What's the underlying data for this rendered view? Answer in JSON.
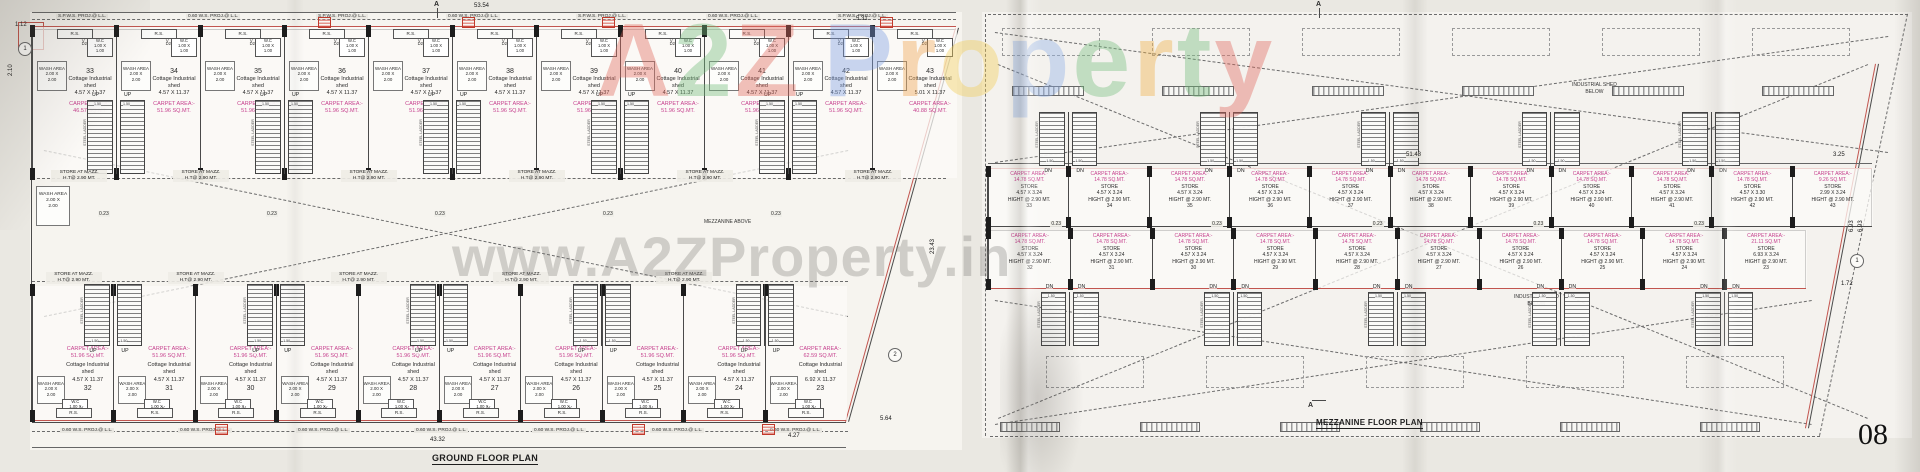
{
  "page": {
    "number": "08"
  },
  "watermark": {
    "brand_letters": [
      {
        "ch": "A",
        "color": "#e2695e"
      },
      {
        "ch": "2",
        "color": "#74bd7c"
      },
      {
        "ch": "Z",
        "color": "#e2695e"
      },
      {
        "ch": "P",
        "color": "#7d9fe3"
      },
      {
        "ch": "r",
        "color": "#f0a44f"
      },
      {
        "ch": "o",
        "color": "#f3ce58"
      },
      {
        "ch": "p",
        "color": "#8fb0e8"
      },
      {
        "ch": "e",
        "color": "#77c07f"
      },
      {
        "ch": "r",
        "color": "#f0b045"
      },
      {
        "ch": "t",
        "color": "#74bd7c"
      },
      {
        "ch": "y",
        "color": "#e2695e"
      }
    ],
    "url_text": "www.A2ZProperty.in"
  },
  "ground_floor": {
    "title": "GROUND FLOOR PLAN",
    "labels": {
      "rs": "R.S.",
      "vent": "V",
      "wc": "W.C",
      "wc_size": "1.00 X",
      "wc_size2": "1.00",
      "door": "D2",
      "wash1": "WASH AREA",
      "wash2": "2.00 X",
      "wash3": "2.00",
      "up": "UP",
      "unit_type1": "Cottage Industrial",
      "unit_type2": "shed",
      "carpet": "CARPET AREA:-",
      "store_mazz1": "STORE AT MAZZ.",
      "store_mazz2": "H.T@ 2.90 MT.",
      "mezz_above": "MEZZANINE ABOVE",
      "steel_ladder": "STEEL LADDER",
      "stair_width": "1.50"
    },
    "dims": {
      "total_top": "53.54",
      "top_right": "5.31",
      "left_offset": "1.12",
      "left_height": "2.10",
      "right_height": "23.43",
      "right_lower": "5.64",
      "bottom_offset": "4.27",
      "total_bottom": "43.32",
      "column_gap": "0.23"
    },
    "markers": {
      "left": "1",
      "right": "2",
      "section": "A"
    },
    "top_edge_labels": [
      "S.P.W.S. PROJ.@ L.L.",
      "0.60 W.S. PROJ.@ L.L.",
      "S.P.W.S. PROJ.@ L.L.",
      "0.60 W.S. PROJ.@ L.L.",
      "S.P.W.S. PROJ.@ L.L.",
      "0.60 W.S. PROJ.@ L.L.",
      "S.P.W.S. PROJ.@ L.L."
    ],
    "bottom_edge_labels": [
      "0.60 W.S. PROJ.@ L.L.",
      "0.60 W.S. PROJ.@ L.L.",
      "0.60 W.S. PROJ.@ L.L.",
      "0.60 W.S. PROJ.@ L.L.",
      "0.60 W.S. PROJ.@ L.L.",
      "0.60 W.S. PROJ.@ L.L.",
      "0.60 W.S. PROJ.@ L.L."
    ],
    "top_units": [
      {
        "no": "33",
        "size": "4.57 X 11.37",
        "area": "46.57 SQ.MT."
      },
      {
        "no": "34",
        "size": "4.57 X 11.37",
        "area": "51.96 SQ.MT."
      },
      {
        "no": "35",
        "size": "4.57 X 11.37",
        "area": "51.96 SQ.MT."
      },
      {
        "no": "36",
        "size": "4.57 X 11.37",
        "area": "51.96 SQ.MT."
      },
      {
        "no": "37",
        "size": "4.57 X 11.37",
        "area": "51.96 SQ.MT."
      },
      {
        "no": "38",
        "size": "4.57 X 11.37",
        "area": "51.96 SQ.MT."
      },
      {
        "no": "39",
        "size": "4.57 X 11.37",
        "area": "51.96 SQ.MT."
      },
      {
        "no": "40",
        "size": "4.57 X 11.37",
        "area": "51.96 SQ.MT."
      },
      {
        "no": "41",
        "size": "4.57 X 11.37",
        "area": "51.96 SQ.MT."
      },
      {
        "no": "42",
        "size": "4.57 X 11.37",
        "area": "51.96 SQ.MT."
      },
      {
        "no": "43",
        "size": "5.01 X 11.37",
        "area": "40.88 SQ.MT."
      }
    ],
    "bottom_units": [
      {
        "no": "32",
        "size": "4.57 X 11.37",
        "area": "51.96 SQ.MT."
      },
      {
        "no": "31",
        "size": "4.57 X 11.37",
        "area": "51.96 SQ.MT."
      },
      {
        "no": "30",
        "size": "4.57 X 11.37",
        "area": "51.96 SQ.MT."
      },
      {
        "no": "29",
        "size": "4.57 X 11.37",
        "area": "51.96 SQ.MT."
      },
      {
        "no": "28",
        "size": "4.57 X 11.37",
        "area": "51.96 SQ.MT."
      },
      {
        "no": "27",
        "size": "4.57 X 11.37",
        "area": "51.96 SQ.MT."
      },
      {
        "no": "26",
        "size": "4.57 X 11.37",
        "area": "51.96 SQ.MT."
      },
      {
        "no": "25",
        "size": "4.57 X 11.37",
        "area": "51.96 SQ.MT."
      },
      {
        "no": "24",
        "size": "4.57 X 11.37",
        "area": "51.96 SQ.MT."
      },
      {
        "no": "23",
        "size": "6.92 X 11.37",
        "area": "62.59 SQ.MT."
      }
    ]
  },
  "mezzanine": {
    "title": "MEZZANINE FLOOR PLAN",
    "labels": {
      "carpet": "CARPET AREA:-",
      "store": "STORE",
      "hight": "HIGHT @ 2.90 MT.",
      "dn": "DN",
      "shed_below1": "INDUSTRIAL SHED",
      "shed_below2": "BELOW",
      "steel_ladder": "STEEL LADDER"
    },
    "dims": {
      "total": "51.48",
      "right_top": "3.25",
      "right_h1": "6.93",
      "right_h2": "6.93",
      "right_lower": "1.72",
      "column_gap": "0.23"
    },
    "markers": {
      "right": "1",
      "section": "A"
    },
    "top_units": [
      {
        "no": "33",
        "area": "14.78 SQ.MT.",
        "size": "4.57 X 3.24"
      },
      {
        "no": "34",
        "area": "14.78 SQ.MT.",
        "size": "4.57 X 3.24"
      },
      {
        "no": "35",
        "area": "14.78 SQ.MT.",
        "size": "4.57 X 3.24"
      },
      {
        "no": "36",
        "area": "14.78 SQ.MT.",
        "size": "4.57 X 3.24"
      },
      {
        "no": "37",
        "area": "14.78 SQ.MT.",
        "size": "4.57 X 3.24"
      },
      {
        "no": "38",
        "area": "14.78 SQ.MT.",
        "size": "4.57 X 3.24"
      },
      {
        "no": "39",
        "area": "14.78 SQ.MT.",
        "size": "4.57 X 3.24"
      },
      {
        "no": "40",
        "area": "14.78 SQ.MT.",
        "size": "4.57 X 3.24"
      },
      {
        "no": "41",
        "area": "14.78 SQ.MT.",
        "size": "4.57 X 3.24"
      },
      {
        "no": "42",
        "area": "14.78 SQ.MT.",
        "size": "4.57 X 3.30"
      },
      {
        "no": "43",
        "area": "9.26 SQ.MT.",
        "size": "2.99 X 3.24"
      }
    ],
    "bottom_units": [
      {
        "no": "32",
        "area": "14.78 SQ.MT.",
        "size": "4.57 X 3.24"
      },
      {
        "no": "31",
        "area": "14.78 SQ.MT.",
        "size": "4.57 X 3.24"
      },
      {
        "no": "30",
        "area": "14.78 SQ.MT.",
        "size": "4.57 X 3.24"
      },
      {
        "no": "29",
        "area": "14.78 SQ.MT.",
        "size": "4.57 X 3.24"
      },
      {
        "no": "28",
        "area": "14.78 SQ.MT.",
        "size": "4.57 X 3.24"
      },
      {
        "no": "27",
        "area": "14.78 SQ.MT.",
        "size": "4.57 X 3.24"
      },
      {
        "no": "26",
        "area": "14.78 SQ.MT.",
        "size": "4.57 X 3.24"
      },
      {
        "no": "25",
        "area": "14.78 SQ.MT.",
        "size": "4.57 X 3.24"
      },
      {
        "no": "24",
        "area": "14.78 SQ.MT.",
        "size": "4.57 X 3.24"
      },
      {
        "no": "23",
        "area": "21.11 SQ.MT",
        "size": "6.93 X 3.24"
      }
    ]
  }
}
